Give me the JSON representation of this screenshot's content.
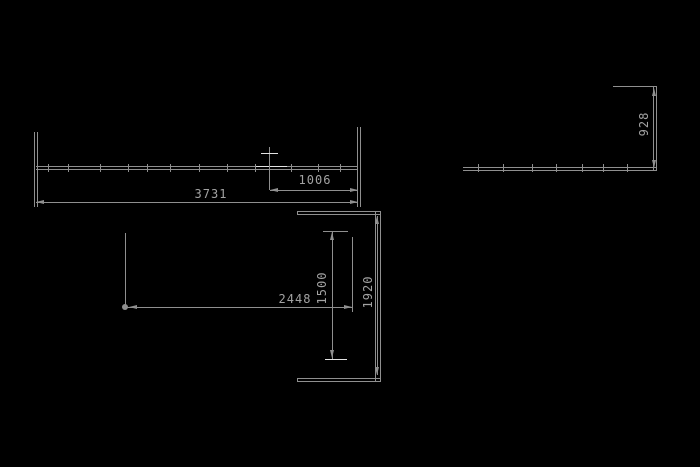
{
  "meta": {
    "type": "cad-technical-drawing",
    "view": "dimensioned plan fragments"
  },
  "colors": {
    "background": "#000000",
    "line": "#8f8f8f",
    "line_bright": "#e2e2e2",
    "text": "#a2a2a2"
  },
  "dimensions": {
    "top_beam": {
      "overall_length": "3731",
      "right_segment": "1006"
    },
    "right_beam": {
      "end_height": "928"
    },
    "bottom_opening": {
      "width": "2448",
      "inner_height": "1500",
      "overall_height": "1920"
    }
  }
}
